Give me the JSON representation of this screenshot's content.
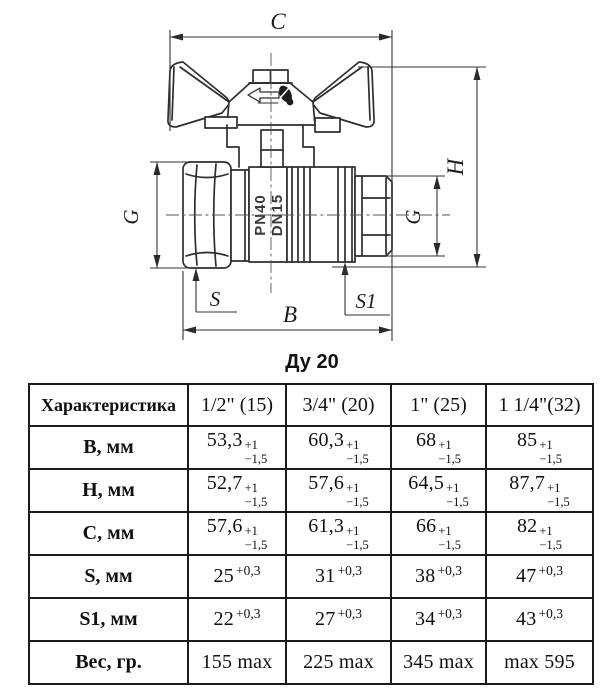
{
  "drawing": {
    "caption": "Ду 20",
    "marking": {
      "line1": "PN40",
      "line2": "DN15"
    },
    "dims": {
      "c": "C",
      "h": "H",
      "g_left": "G",
      "g_right": "G",
      "s": "S",
      "s1": "S1",
      "b": "B"
    }
  },
  "table": {
    "header": [
      "Характеристика",
      "1/2\" (15)",
      "3/4\" (20)",
      "1\" (25)",
      "1 1/4\"(32)"
    ],
    "rows": [
      {
        "label": "B, мм",
        "cells": [
          {
            "v": "53,3",
            "sup": "+1",
            "sub": "−1,5"
          },
          {
            "v": "60,3",
            "sup": "+1",
            "sub": "−1,5"
          },
          {
            "v": "68",
            "sup": "+1",
            "sub": "−1,5"
          },
          {
            "v": "85",
            "sup": "+1",
            "sub": "−1,5"
          }
        ]
      },
      {
        "label": "H, мм",
        "cells": [
          {
            "v": "52,7",
            "sup": "+1",
            "sub": "−1,5"
          },
          {
            "v": "57,6",
            "sup": "+1",
            "sub": "−1,5"
          },
          {
            "v": "64,5",
            "sup": "+1",
            "sub": "−1,5"
          },
          {
            "v": "87,7",
            "sup": "+1",
            "sub": "−1,5"
          }
        ]
      },
      {
        "label": "C, мм",
        "cells": [
          {
            "v": "57,6",
            "sup": "+1",
            "sub": "−1,5"
          },
          {
            "v": "61,3",
            "sup": "+1",
            "sub": "−1,5"
          },
          {
            "v": "66",
            "sup": "+1",
            "sub": "−1,5"
          },
          {
            "v": "82",
            "sup": "+1",
            "sub": "−1,5"
          }
        ]
      },
      {
        "label": "S, мм",
        "cells": [
          {
            "v": "25",
            "sup": "+0,3"
          },
          {
            "v": "31",
            "sup": "+0,3"
          },
          {
            "v": "38",
            "sup": "+0,3"
          },
          {
            "v": "47",
            "sup": "+0,3"
          }
        ]
      },
      {
        "label": "S1, мм",
        "cells": [
          {
            "v": "22",
            "sup": "+0,3"
          },
          {
            "v": "27",
            "sup": "+0,3"
          },
          {
            "v": "34",
            "sup": "+0,3"
          },
          {
            "v": "43",
            "sup": "+0,3"
          }
        ]
      },
      {
        "label": "Вес, гр.",
        "cells": [
          {
            "v": "155 max"
          },
          {
            "v": "225 max"
          },
          {
            "v": "345 max"
          },
          {
            "v": "max 595"
          }
        ]
      }
    ]
  },
  "colors": {
    "line": "#2e2e2e",
    "dim": "#333333",
    "border": "#1b1b1b",
    "background": "#ffffff"
  }
}
